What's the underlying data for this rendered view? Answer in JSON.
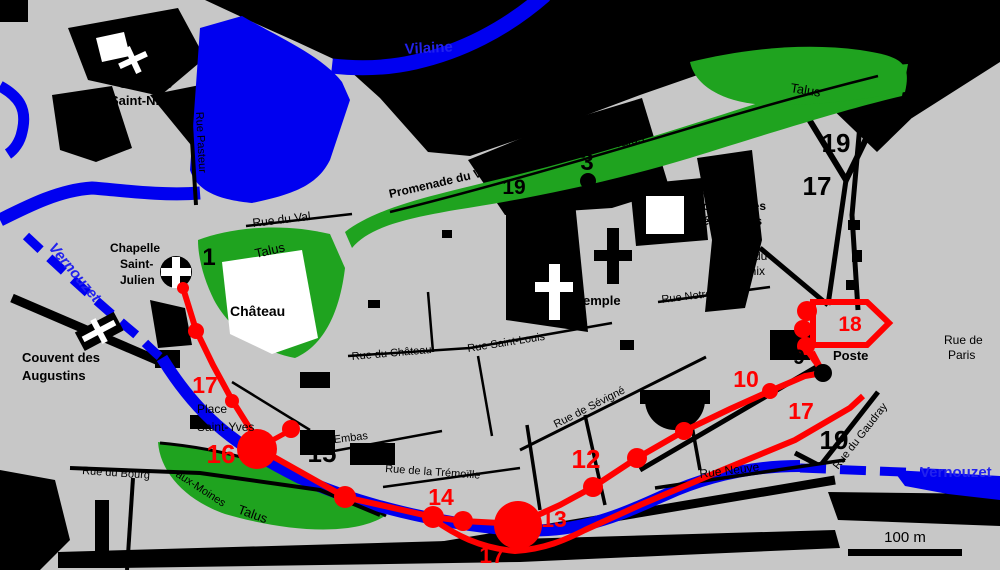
{
  "map": {
    "rivers": {
      "vilaine": "Vilaine",
      "vernouzet_left": "Vernouzet",
      "vernouzet_right": "Vernouzet"
    },
    "green": {
      "talus_ne": "Talus",
      "talus_band": "Talus",
      "talus_chateau": "Talus",
      "talus_sw": "Talus",
      "promenade_du_val": "Promenade du Val"
    },
    "buildings": {
      "chapelle_saint_nicolas": {
        "lines": [
          "Chapelle",
          "Saint-Nicolas"
        ]
      },
      "chapelle_saint_julien": {
        "lines": [
          "Chapelle",
          "Saint-",
          "Julien"
        ]
      },
      "couvent_des_augustins": {
        "lines": [
          "Couvent des",
          "Augustins"
        ]
      },
      "couvent_des_benedictins": {
        "lines": [
          "Couvent des",
          "Bénédictins"
        ]
      },
      "temple": "Temple",
      "chateau": "Château",
      "poste": "Poste"
    },
    "places": {
      "place_du_marchix": {
        "lines": [
          "Place du",
          "Marchix"
        ]
      },
      "place_saint_yves": {
        "lines": [
          "Place",
          "Saint-Yves"
        ]
      }
    },
    "streets": {
      "rue_pasteur": "Rue Pasteur",
      "rue_du_val": "Rue du Val",
      "rue_saint_louis": "Rue Saint-Louis",
      "rue_du_chateau": "Rue du Château",
      "rue_notre_dame": "Rue Notre-Dame",
      "rue_de_sevigne": "Rue de Sévigné",
      "rue_neuve": "Rue Neuve",
      "rue_d_embas": "Rue d'Embas",
      "rue_de_la_tremoille": "Rue de la Trémoïlle",
      "rue_du_bourg": "Rue du Bourg",
      "aux_moines": "-aux-Moines",
      "rue_du_gaudray": "Rue du Gaudray",
      "rue_de_paris_l1": "Rue de",
      "rue_de_paris_l2": "Paris"
    },
    "numbers_black": {
      "n1": "1",
      "n3": "3",
      "n19_promenade": "19",
      "n19_ne": "19",
      "n17_ne": "17",
      "n9": "9",
      "n11": "11",
      "n15": "15",
      "n19_se": "19"
    },
    "numbers_red": {
      "n17_west": "17",
      "n16": "16",
      "n14": "14",
      "n13": "13",
      "n17_south": "17",
      "n12": "12",
      "n10": "10",
      "n17_east": "17",
      "n18": "18"
    },
    "scale_bar": {
      "label": "100 m"
    },
    "colors": {
      "background": "#c7c7c7",
      "water": "#0000f0",
      "vegetation": "#1fa31f",
      "wall": "#ff0000",
      "built": "#000000"
    }
  }
}
